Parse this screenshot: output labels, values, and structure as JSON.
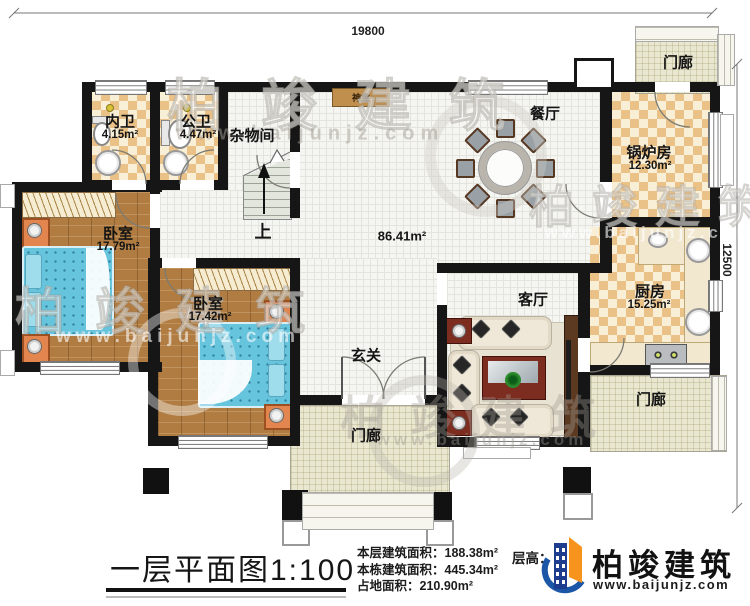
{
  "dimensions": {
    "top": "19800",
    "right": "12500"
  },
  "watermark": {
    "brand": "柏竣建筑",
    "site": "www.baijunjz.com"
  },
  "rooms": {
    "bath_inner": {
      "name": "内卫",
      "area": "4.15m²"
    },
    "bath_public": {
      "name": "公卫",
      "area": "4.47m²"
    },
    "storage": {
      "name": "杂物间"
    },
    "shrine": {
      "name": "神龛"
    },
    "stairs": {
      "label": "上"
    },
    "bedroom1": {
      "name": "卧室",
      "area": "17.79m²"
    },
    "bedroom2": {
      "name": "卧室",
      "area": "17.42m²"
    },
    "hall": {
      "area": "86.41m²"
    },
    "dining": {
      "name": "餐厅"
    },
    "boiler": {
      "name": "锅炉房",
      "area": "12.30m²"
    },
    "kitchen": {
      "name": "厨房",
      "area": "15.25m²"
    },
    "living": {
      "name": "客厅"
    },
    "entry": {
      "name": "玄关"
    },
    "porch_top": {
      "name": "门廊"
    },
    "porch_bottom": {
      "name": "门廊"
    },
    "porch_right": {
      "name": "门廊"
    }
  },
  "titleblock": {
    "title": "一层平面图1:100",
    "stats": [
      {
        "label": "本层建筑面积：",
        "value": "188.38m²"
      },
      {
        "label": "本栋建筑面积：",
        "value": "445.34m²"
      },
      {
        "label": "占地面积：",
        "value": "210.90m²"
      }
    ],
    "floor_height_label": "层高："
  },
  "logo": {
    "brand": "柏竣建筑",
    "site": "www.baijunjz.com"
  },
  "colors": {
    "wall": "#161616",
    "checker": "#eac187",
    "wood": "#b07c42",
    "bed": "#66c4dd",
    "porch": "#eae7d0",
    "logo_blue": "#1b57a6",
    "logo_orange": "#f7941d"
  }
}
